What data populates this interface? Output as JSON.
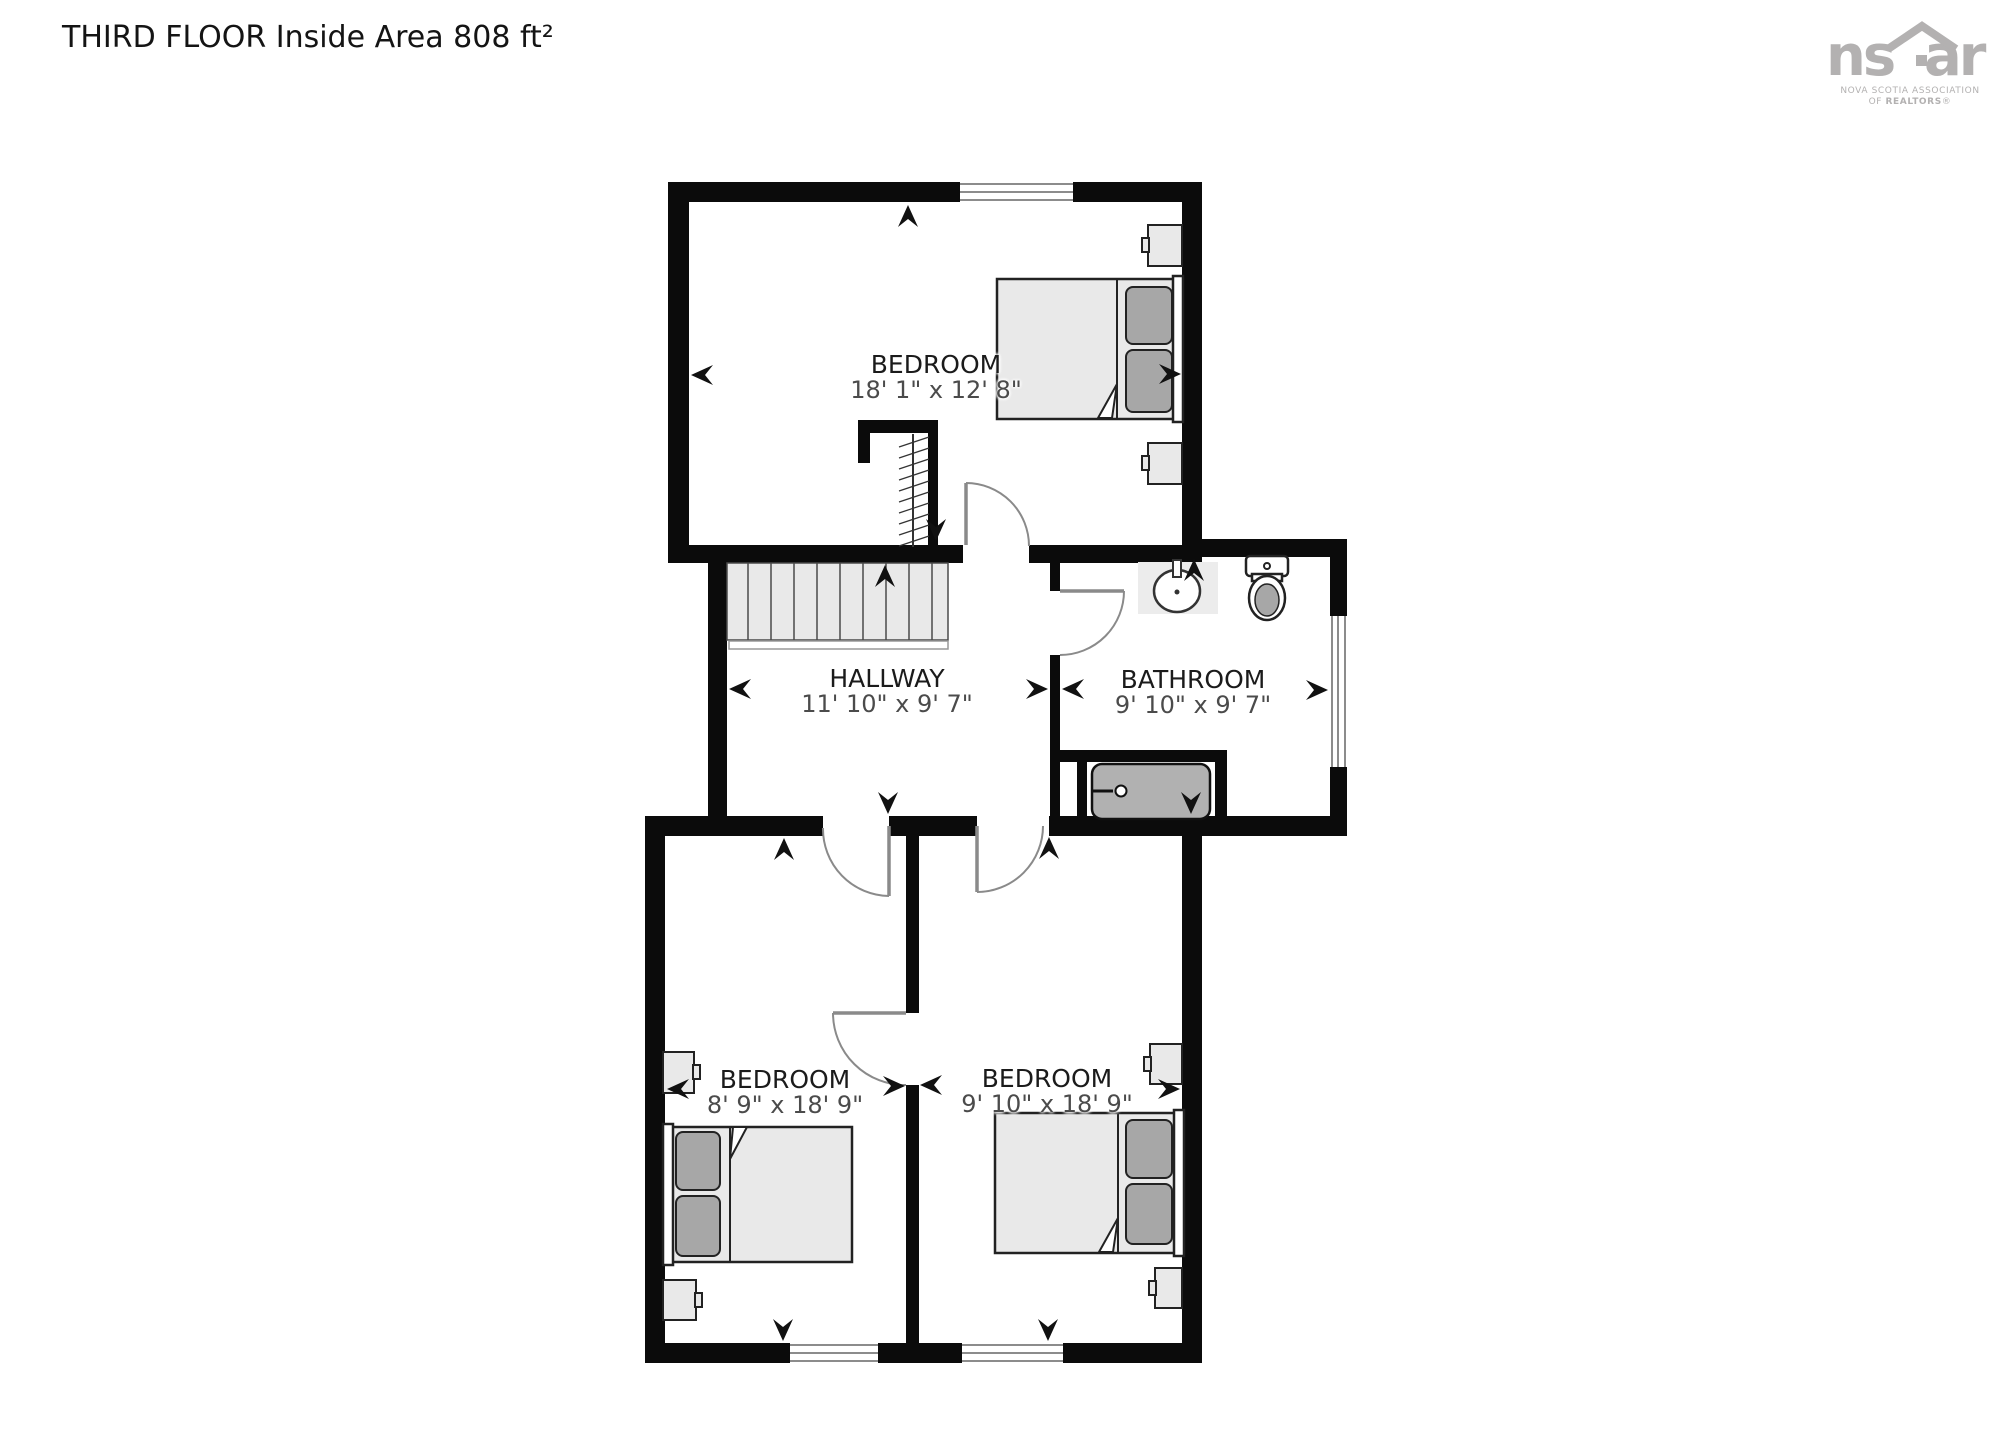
{
  "title": "THIRD FLOOR Inside Area 808 ft²",
  "logo": {
    "brand_left": "ns",
    "brand_right": "ar",
    "subtitle_line1": "NOVA SCOTIA ASSOCIATION",
    "subtitle_line2_prefix": "OF ",
    "subtitle_line2_bold": "REALTORS",
    "subtitle_line2_sym": "®"
  },
  "rooms": [
    {
      "id": "bedroom-top",
      "name": "BEDROOM",
      "dims": "18' 1\" x 12' 8\""
    },
    {
      "id": "hallway",
      "name": "HALLWAY",
      "dims": "11' 10\" x 9' 7\""
    },
    {
      "id": "bathroom",
      "name": "BATHROOM",
      "dims": "9' 10\" x 9' 7\""
    },
    {
      "id": "bedroom-left",
      "name": "BEDROOM",
      "dims": "8' 9\" x 18' 9\""
    },
    {
      "id": "bedroom-right",
      "name": "BEDROOM",
      "dims": "9' 10\" x 18' 9\""
    }
  ],
  "colors": {
    "background": "#ffffff",
    "wall": "#0b0b0b",
    "furniture_fill": "#e9e9e9",
    "pillow_fill": "#a7a7a7",
    "tub_fill": "#b1b1b1",
    "door_swing": "#8a8a8a",
    "window_line": "#8c8c8c",
    "room_name_text": "#1b1b1b",
    "room_dims_text": "#4b4b4b",
    "logo_gray": "#b3b1b1"
  }
}
